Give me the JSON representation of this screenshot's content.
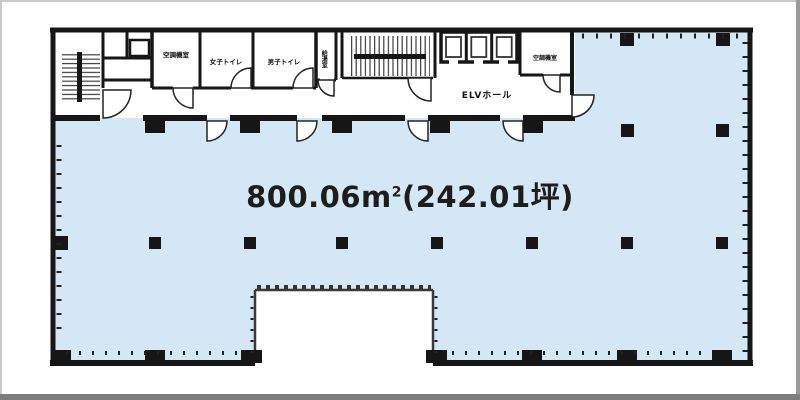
{
  "floor_plan": {
    "area_label": {
      "m2": "800.06m",
      "sup": "2",
      "tsubo": "(242.01坪)"
    },
    "rooms": [
      {
        "id": "machine-room-left",
        "label": "空調機室"
      },
      {
        "id": "womens-toilet",
        "label": "女子トイレ"
      },
      {
        "id": "mens-toilet",
        "label": "男子トイレ"
      },
      {
        "id": "kitchenette",
        "label": "給湯室"
      },
      {
        "id": "elevator-hall",
        "label": "ELVホール"
      },
      {
        "id": "machine-room-right",
        "label": "空調機室"
      }
    ],
    "colors": {
      "floor_fill": "#d3e7f4",
      "wall": "#161616",
      "frame_light": "#c9c9c9",
      "frame_dark": "#7d7d7d",
      "background": "#ffffff",
      "label_text": "#1d1d1d"
    }
  }
}
